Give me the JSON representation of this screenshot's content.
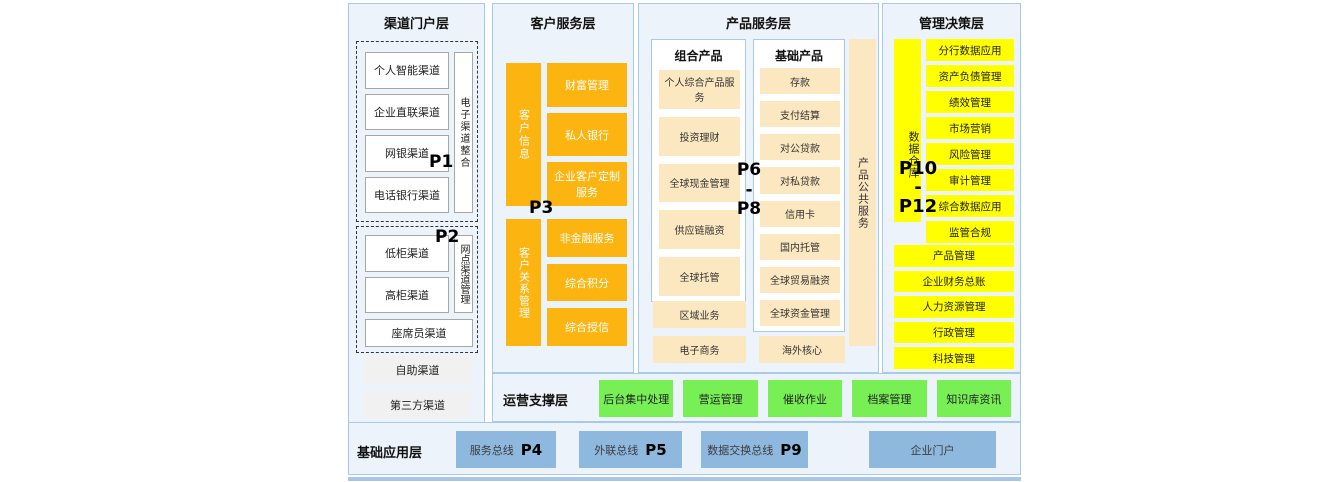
{
  "colors": {
    "orange": "#FBB410",
    "cream": "#FCE8C0",
    "yellow": "#FFFF00",
    "green": "#77EF55",
    "blue_box": "#8FB8DF",
    "panel_bg": "#EDF3FA",
    "panel_border": "#A9C9E8",
    "bottom_strip": "#A8C6E8"
  },
  "channel": {
    "title": "渠道门户层",
    "p1": "P1",
    "p2": "P2",
    "group1": {
      "boxes": [
        "个人智能渠道",
        "企业直联渠道",
        "网银渠道",
        "电话银行渠道"
      ],
      "vertical": "电子渠道整合"
    },
    "group2": {
      "boxes": [
        "低柜渠道",
        "高柜渠道"
      ],
      "vertical": "网点渠道管理",
      "wide": "座席员渠道"
    },
    "extra": [
      "自助渠道",
      "第三方渠道"
    ]
  },
  "customer": {
    "title": "客户服务层",
    "p3": "P3",
    "vertical1": "客户信息",
    "vertical2": "客户关系管理",
    "boxes1": [
      "财富管理",
      "私人银行",
      "企业客户定制服务"
    ],
    "boxes2": [
      "非金融服务",
      "综合积分",
      "综合授信"
    ]
  },
  "product": {
    "title": "产品服务层",
    "p6": "P6",
    "dash": "-",
    "p8": "P8",
    "combo": {
      "title": "组合产品",
      "boxes": [
        "个人综合产品服务",
        "投资理财",
        "全球现金管理",
        "供应链融资",
        "全球托管"
      ]
    },
    "basic": {
      "title": "基础产品",
      "boxes": [
        "存款",
        "支付结算",
        "对公贷款",
        "对私贷款",
        "信用卡",
        "国内托管",
        "全球贸易融资",
        "全球资金管理"
      ]
    },
    "vertical": "产品公共服务",
    "bottom": [
      "区域业务",
      "电子商务",
      "海外核心"
    ]
  },
  "management": {
    "title": "管理决策层",
    "vertical": "数据仓库",
    "p10": "P10",
    "dash": "-",
    "p12": "P12",
    "boxes": [
      "分行数据应用",
      "资产负债管理",
      "绩效管理",
      "市场营销",
      "风险管理",
      "审计管理",
      "综合数据应用",
      "监管合规"
    ],
    "wide_boxes": [
      "产品管理",
      "企业财务总账",
      "人力资源管理",
      "行政管理",
      "科技管理"
    ]
  },
  "ops": {
    "title": "运营支撑层",
    "boxes": [
      "后台集中处理",
      "营运管理",
      "催收作业",
      "档案管理",
      "知识库资讯"
    ]
  },
  "base": {
    "title": "基础应用层",
    "boxes": [
      {
        "label": "服务总线",
        "p": "P4"
      },
      {
        "label": "外联总线",
        "p": "P5"
      },
      {
        "label": "数据交换总线",
        "p": "P9"
      },
      {
        "label": "企业门户",
        "p": ""
      }
    ]
  }
}
